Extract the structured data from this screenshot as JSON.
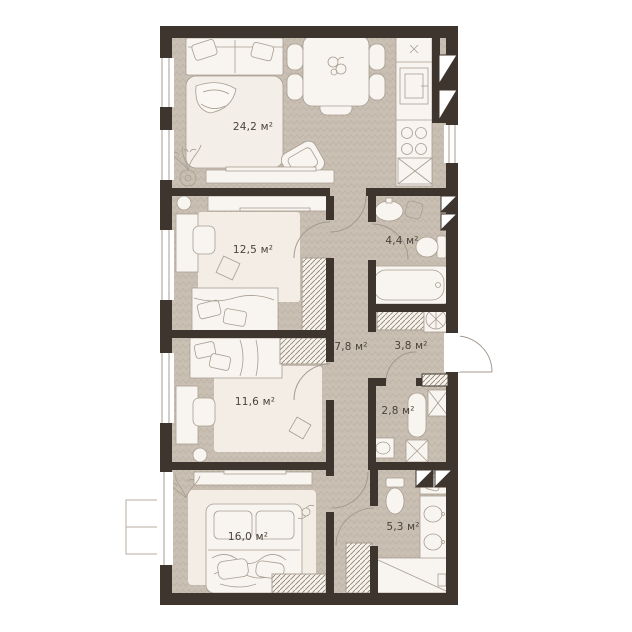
{
  "plan": {
    "title": "apartment-floor-plan",
    "area_unit": "м²",
    "rooms": [
      {
        "id": "living-kitchen",
        "label": "24,2 м²",
        "features": [
          "sofa",
          "bed",
          "dining-table",
          "chairs",
          "kitchen-counter",
          "sink",
          "stove",
          "tv-console",
          "armchair",
          "plant"
        ]
      },
      {
        "id": "bedroom-1",
        "label": "12,5 м²",
        "features": [
          "bed",
          "desk",
          "chair",
          "wardrobe",
          "dresser",
          "rug"
        ]
      },
      {
        "id": "bathroom-1",
        "label": "4,4 м²",
        "features": [
          "washbasin",
          "basket",
          "toilet",
          "bathtub"
        ]
      },
      {
        "id": "corridor",
        "label": "7,8 м²",
        "features": []
      },
      {
        "id": "entry-hall",
        "label": "3,8 м²",
        "features": [
          "wardrobe",
          "water-heater",
          "entrance-door"
        ]
      },
      {
        "id": "bedroom-2",
        "label": "11,6 м²",
        "features": [
          "bed",
          "desk",
          "chair",
          "wardrobe",
          "rug"
        ]
      },
      {
        "id": "wc",
        "label": "2,8 м²",
        "features": [
          "shower",
          "toilet",
          "washbasin"
        ]
      },
      {
        "id": "bedroom-3",
        "label": "16,0 м²",
        "features": [
          "bed",
          "tv-console",
          "wardrobe",
          "plant",
          "rug"
        ]
      },
      {
        "id": "bathroom-2",
        "label": "5,3 м²",
        "features": [
          "toilet",
          "double-washbasin",
          "shower-tray"
        ]
      }
    ],
    "colors": {
      "wall": "#3E362E",
      "floor": "#C9BFB3",
      "floor_line": "#BDB2A5",
      "furniture": "#F8F4EF",
      "furniture_outline": "#A89E92",
      "rug": "#F3EDE6",
      "label_text": "#4A433C"
    }
  }
}
